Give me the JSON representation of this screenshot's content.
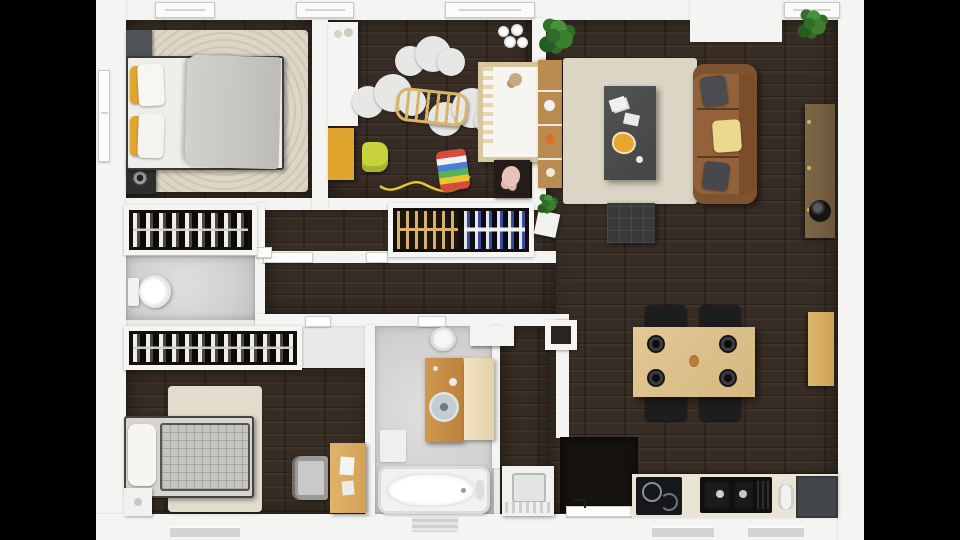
{
  "scene": {
    "title": "Two-bedroom apartment 3D floor plan, top-down render",
    "view": "top-down",
    "letterbox": "black side bars",
    "colors": {
      "background": "#000000",
      "wall": "#f4f4f2",
      "wood_floor": "#33281f",
      "tile_floor": "#d6d5d3",
      "rug_cream": "#ddd5c5",
      "sofa_leather": "#8a5a35",
      "coffee_table_gray": "#4b4d4e",
      "dining_wood": "#dcc08a",
      "chair_black": "#1d1d1f",
      "accent_mustard": "#dfa52f",
      "accent_yellow": "#e9d68c",
      "toy_lime": "#c8d23c",
      "toy_pink": "#e9c2bb",
      "plant_green": "#2f6d28",
      "counter_cream": "#e9e4d3",
      "appliance_black": "#17181c",
      "closet_interior": "#140f0b"
    }
  },
  "rooms": [
    {
      "name": "bedroom-1",
      "furniture": [
        "double-bed",
        "white-duvet",
        "gray-blanket",
        "yellow-cushions",
        "area-rug",
        "nightstand",
        "floor-heater"
      ]
    },
    {
      "name": "hall-closet-upper",
      "furniture": [
        "hanging-clothes-rail"
      ]
    },
    {
      "name": "wc",
      "furniture": [
        "toilet"
      ]
    },
    {
      "name": "hall-closet-lower",
      "furniture": [
        "hanging-clothes-rail"
      ]
    },
    {
      "name": "bedroom-2",
      "furniture": [
        "single-bed",
        "plaid-blanket",
        "area-rug",
        "nightstand",
        "desk",
        "office-chair"
      ]
    },
    {
      "name": "nursery",
      "furniture": [
        "white-wardrobe",
        "mustard-dresser",
        "toy-car",
        "cloud-rugs",
        "baby-gym",
        "crib",
        "teddy-bear",
        "pull-toy",
        "plush-bunny",
        "ceiling-lamp"
      ]
    },
    {
      "name": "hallway",
      "furniture": [
        "wardrobe-two-rails",
        "plant-stand",
        "white-console"
      ]
    },
    {
      "name": "bathroom",
      "furniture": [
        "ceiling-lamp",
        "wood-vanity",
        "round-sink",
        "tall-cabinet",
        "bath-mat",
        "bathtub"
      ]
    },
    {
      "name": "entry",
      "furniture": [
        "washing-machine",
        "black-doormat",
        "entry-door"
      ]
    },
    {
      "name": "living-dining-kitchen",
      "furniture": [
        "bookshelf",
        "potted-plants",
        "area-rug",
        "coffee-table",
        "magazines",
        "decor-bowl",
        "leather-sofa",
        "sofa-cushions",
        "ottoman",
        "wood-sideboard",
        "black-bowl",
        "dining-table",
        "dinner-plates",
        "dining-chairs",
        "wood-cabinet",
        "kitchen-counter",
        "induction-cooktop",
        "double-sink",
        "dish-rack",
        "dark-counter"
      ]
    }
  ]
}
